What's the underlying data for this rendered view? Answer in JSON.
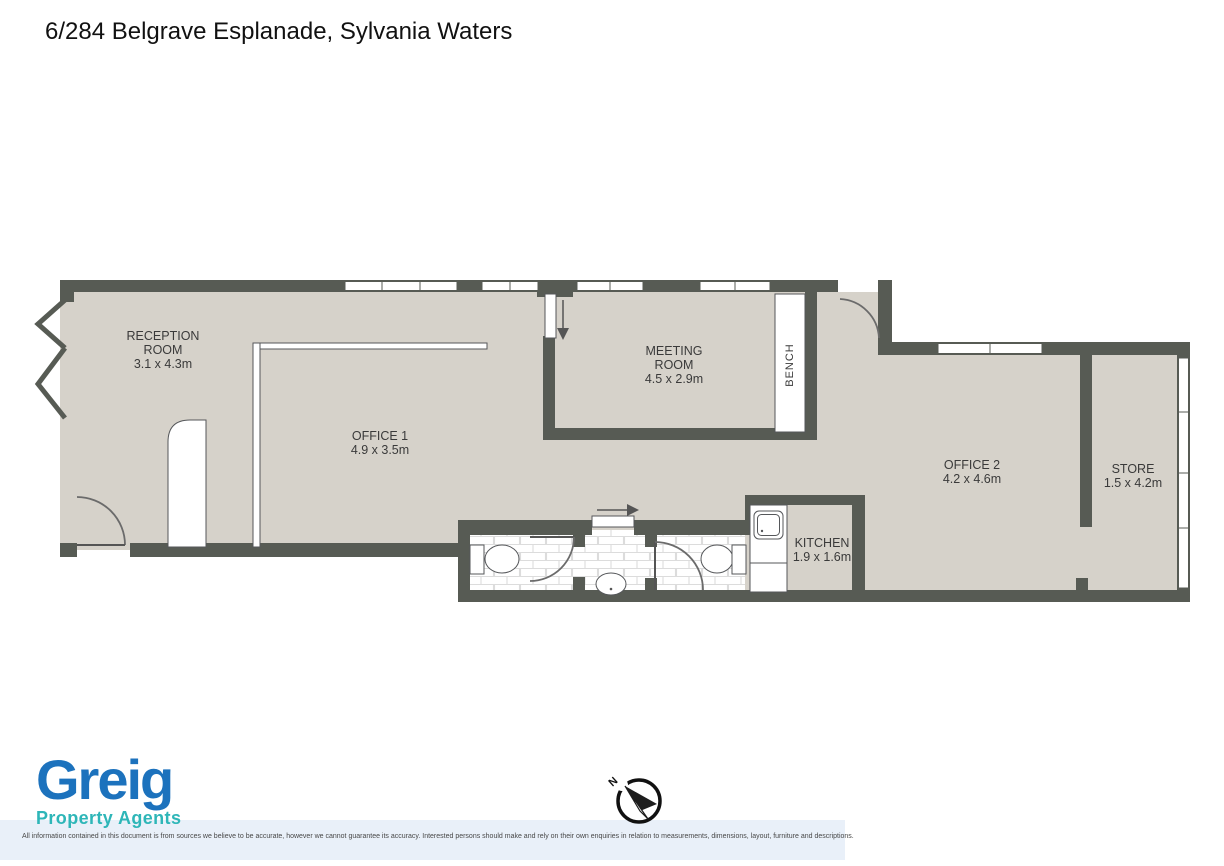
{
  "title": "6/284 Belgrave Esplanade, Sylvania Waters",
  "rooms": {
    "reception": {
      "line1": "RECEPTION",
      "line2": "ROOM",
      "dims": "3.1 x 4.3m"
    },
    "office1": {
      "line1": "OFFICE 1",
      "dims": "4.9 x 3.5m"
    },
    "meeting": {
      "line1": "MEETING",
      "line2": "ROOM",
      "dims": "4.5 x 2.9m"
    },
    "office2": {
      "line1": "OFFICE 2",
      "dims": "4.2 x 4.6m"
    },
    "store": {
      "line1": "STORE",
      "dims": "1.5 x 4.2m"
    },
    "kitchen": {
      "line1": "KITCHEN",
      "dims": "1.9 x 1.6m"
    },
    "bench": {
      "label": "BENCH"
    }
  },
  "compass": {
    "north_label": "N"
  },
  "logo": {
    "name": "Greig",
    "tagline": "Property Agents"
  },
  "disclaimer": "All information contained in this document is from sources we believe to be accurate, however we cannot guarantee its accuracy. Interested persons should make and rely on their own enquiries in relation to measurements, dimensions, layout, furniture and descriptions.",
  "colors": {
    "wall": "#575b54",
    "floor": "#d6d2ca",
    "fixture_outline": "#55575a",
    "tile_line": "#dcdcdc",
    "logo_blue": "#1c72bd",
    "logo_teal": "#2eb6b8",
    "label_text": "#3a3a3a",
    "band_blue": "#e9f0f9"
  }
}
